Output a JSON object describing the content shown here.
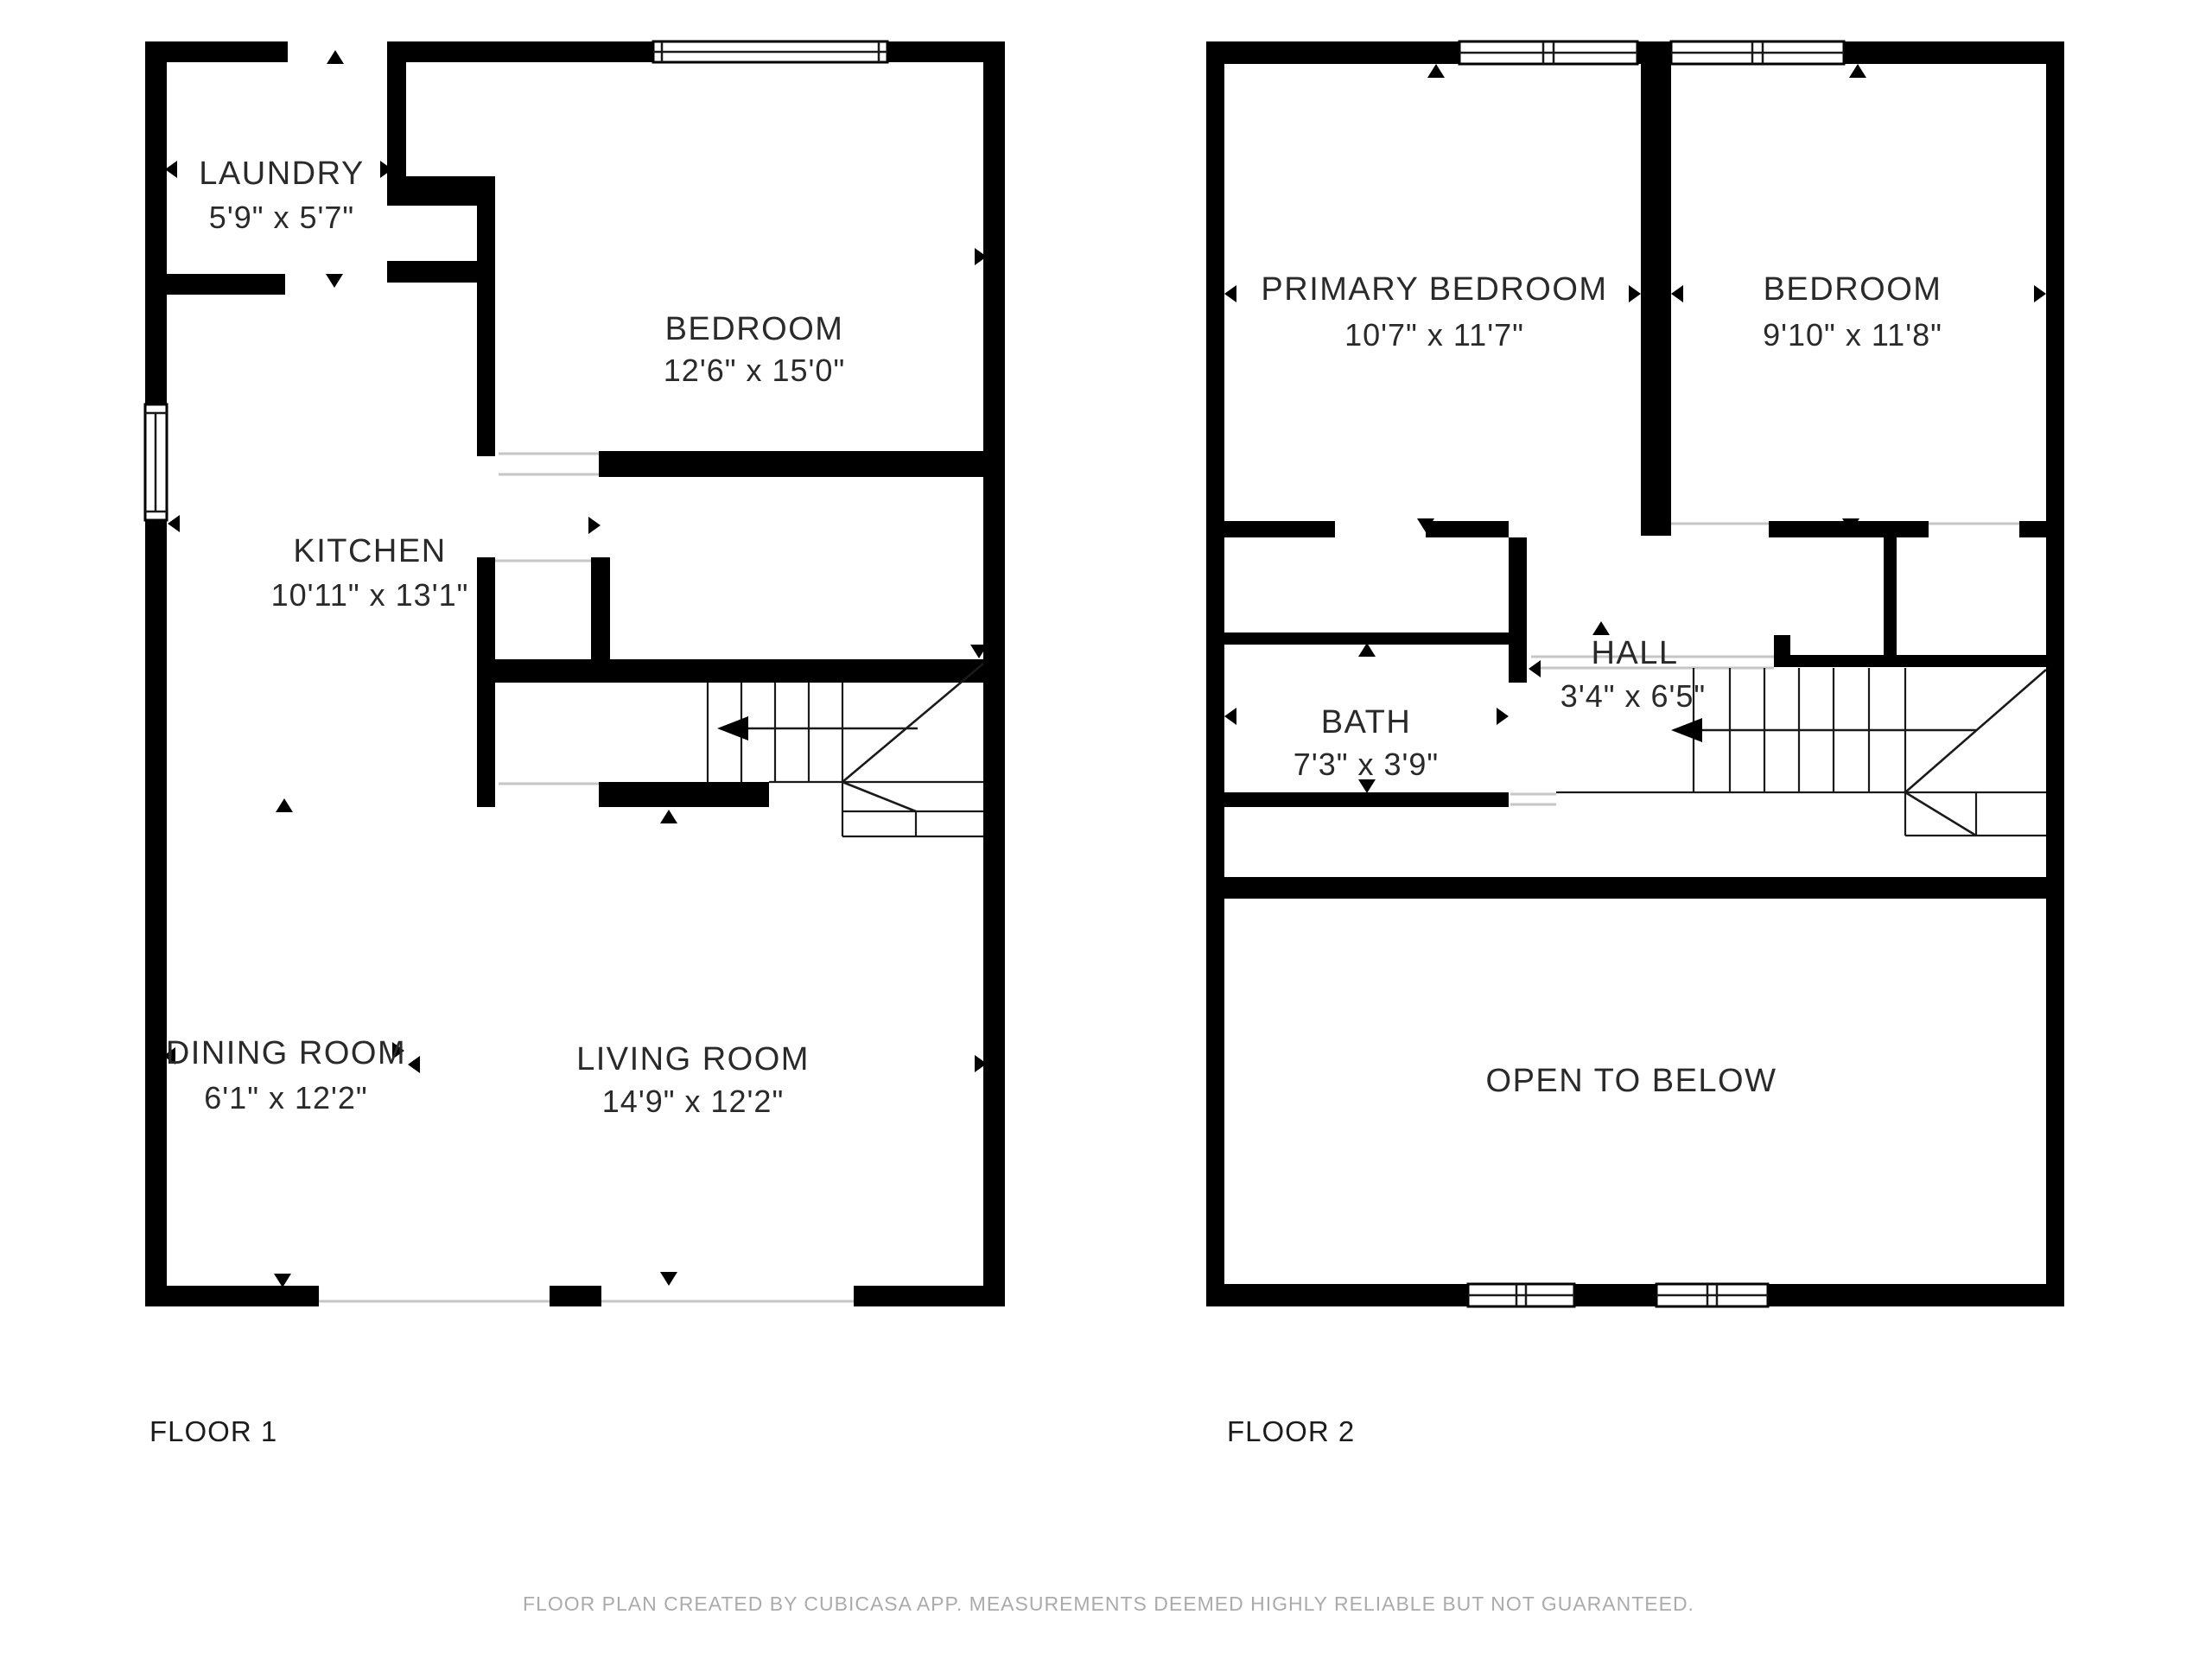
{
  "floor1": {
    "label": "FLOOR 1",
    "rooms": {
      "laundry": {
        "name": "LAUNDRY",
        "dims": "5'9\" x 5'7\""
      },
      "bedroom": {
        "name": "BEDROOM",
        "dims": "12'6\" x 15'0\""
      },
      "kitchen": {
        "name": "KITCHEN",
        "dims": "10'11\" x 13'1\""
      },
      "dining": {
        "name": "DINING ROOM",
        "dims": "6'1\" x 12'2\""
      },
      "living": {
        "name": "LIVING ROOM",
        "dims": "14'9\" x 12'2\""
      }
    }
  },
  "floor2": {
    "label": "FLOOR 2",
    "rooms": {
      "primary": {
        "name": "PRIMARY BEDROOM",
        "dims": "10'7\" x 11'7\""
      },
      "bedroom": {
        "name": "BEDROOM",
        "dims": "9'10\" x 11'8\""
      },
      "hall": {
        "name": "HALL",
        "dims": "3'4\" x 6'5\""
      },
      "bath": {
        "name": "BATH",
        "dims": "7'3\" x 3'9\""
      },
      "open_to_below": {
        "name": "OPEN TO BELOW"
      }
    }
  },
  "footer": {
    "disclaimer": "FLOOR PLAN CREATED BY CUBICASA APP. MEASUREMENTS DEEMED HIGHLY RELIABLE BUT NOT GUARANTEED."
  },
  "colors": {
    "wall": "#000000",
    "label_text": "#2a2a2a",
    "footer_text": "#ababab",
    "opening_line": "#c6c6c6",
    "stair_line": "#1a1a1a",
    "background": "#ffffff"
  }
}
